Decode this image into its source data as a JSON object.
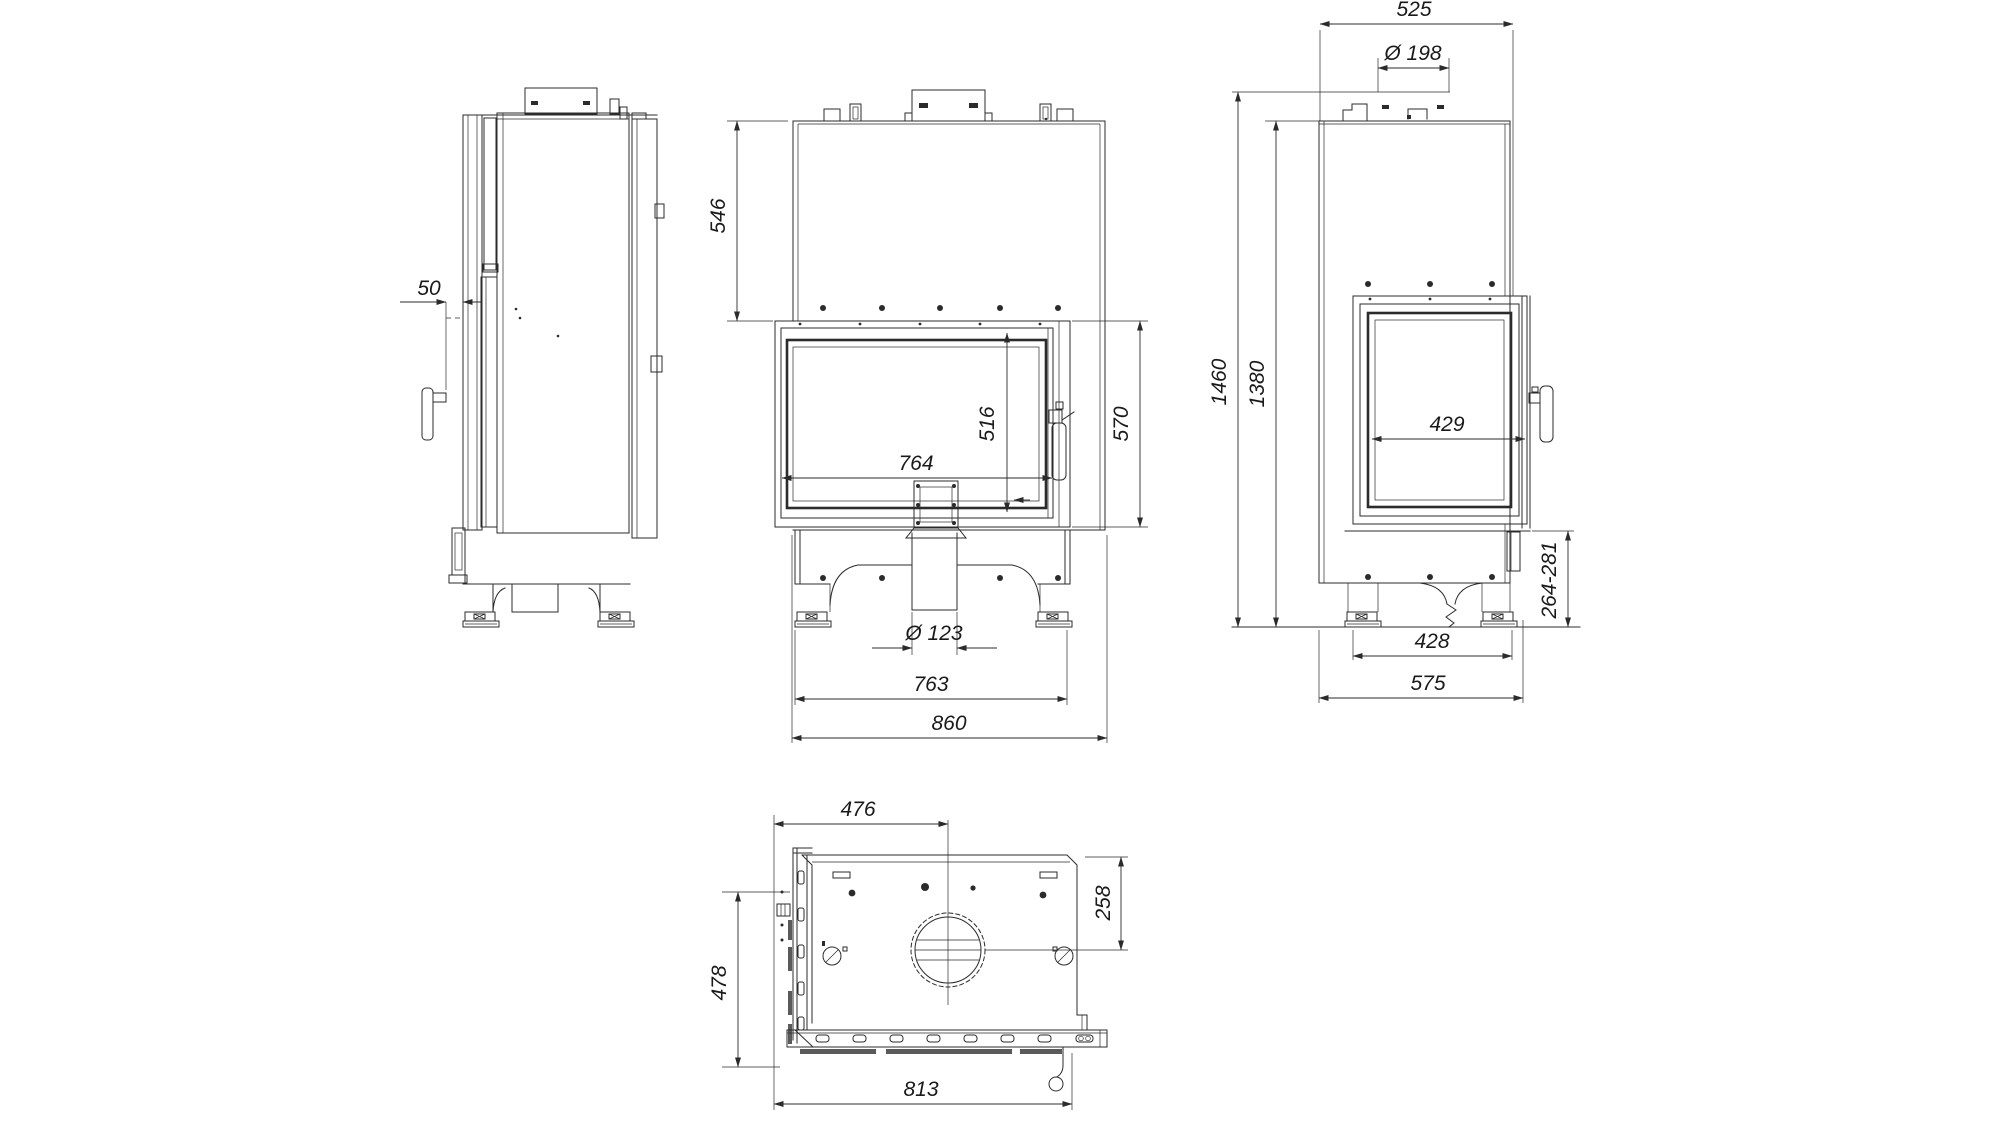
{
  "page": {
    "background": "#ffffff",
    "line_color": "#2b2b2b"
  },
  "drawing": {
    "units": "mm",
    "views": {
      "left_side": {
        "dims": {
          "front_frame_offset": "50"
        }
      },
      "front": {
        "dims": {
          "top_to_door": "546",
          "glass_height": "516",
          "door_height": "570",
          "glass_width": "764",
          "air_inlet_diameter": "Ø 123",
          "base_width": "763",
          "overall_width": "860"
        }
      },
      "right_side": {
        "dims": {
          "top_depth": "525",
          "flue_diameter": "Ø 198",
          "overall_height": "1460",
          "body_height": "1380",
          "side_glass_width": "429",
          "plinth_height_range": "264-281",
          "foot_spacing": "428",
          "overall_depth": "575"
        }
      },
      "top": {
        "dims": {
          "left_to_flue_center": "476",
          "back_to_flue_center": "258",
          "depth_to_front": "478",
          "overall_width_with_door": "813"
        }
      }
    }
  }
}
